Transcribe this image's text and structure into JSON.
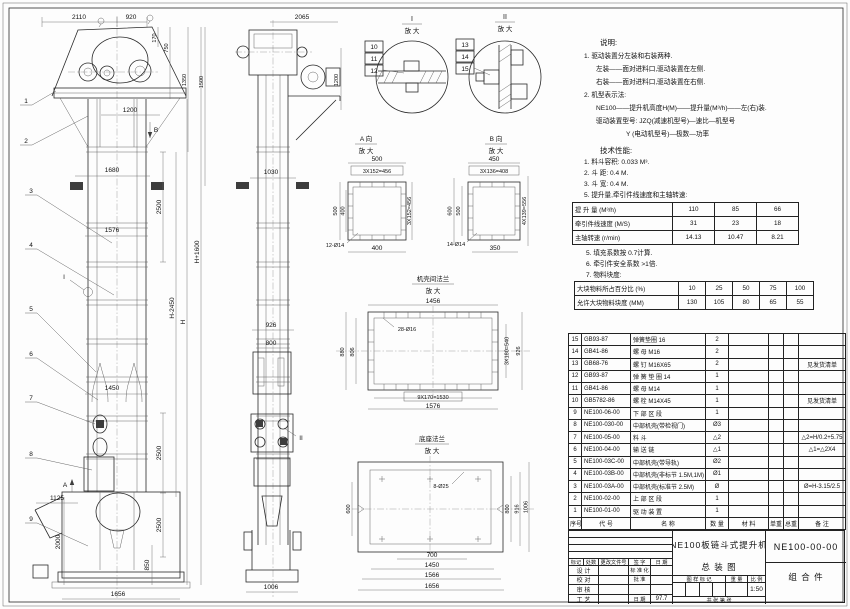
{
  "front_view": {
    "dims": {
      "a2110": "2110",
      "a920": "920",
      "a170": "170",
      "a750": "750",
      "a1350": "1350",
      "a1500": "1500",
      "a1200": "1200",
      "a1680": "1680",
      "a2500": "2500",
      "a1576": "1576",
      "aH1600": "H+1600",
      "aH2450": "H-2450",
      "aH": "H",
      "a1450": "1450",
      "a2500b": "2500",
      "a2500c": "2500",
      "a1125": "1125",
      "a2000": "2000",
      "a850": "850",
      "a1656": "1656"
    },
    "balloons": [
      "1",
      "2",
      "3",
      "4",
      "5",
      "6",
      "7",
      "8",
      "9"
    ],
    "labels": {
      "A": "A",
      "B": "B",
      "I": "I"
    }
  },
  "side_view": {
    "dims": {
      "a2065": "2065",
      "a1200": "1200",
      "a1030": "1030",
      "a926": "926",
      "a800": "800",
      "a1006": "1006"
    },
    "label_II": "II"
  },
  "detail_I": {
    "title": "I",
    "sub": "放 大",
    "balloons": [
      "10",
      "11",
      "12"
    ]
  },
  "detail_II": {
    "title": "II",
    "sub": "放 大",
    "balloons": [
      "13",
      "14",
      "15"
    ]
  },
  "view_A": {
    "title": "A 向",
    "sub": "放 大",
    "dims": {
      "top": "500",
      "top2": "3X152=456",
      "left": "500",
      "left2": "400",
      "right": "3X152=456",
      "bottom": "400",
      "holes": "12-Ø14"
    }
  },
  "view_B": {
    "title": "B 向",
    "sub": "放 大",
    "dims": {
      "top": "450",
      "top2": "3X136=408",
      "left": "600",
      "left2": "500",
      "right": "4X139=556",
      "bottom": "350",
      "holes": "14-Ø14"
    }
  },
  "flange_view": {
    "title": "机壳间法兰",
    "sub": "放 大",
    "dims": {
      "top": "1456",
      "holes": "28-Ø16",
      "left": "880",
      "left2": "806",
      "right": "3X180=540",
      "right2": "926",
      "bottom": "9X170=1530",
      "bottom2": "1576"
    }
  },
  "base_view": {
    "title": "底座法兰",
    "sub": "放 大",
    "dims": {
      "holes": "8-Ø25",
      "left": "600",
      "right": "800",
      "right2": "916",
      "right3": "1006",
      "bottom": "700",
      "bottom2": "1450",
      "bottom3": "1566",
      "bottom4": "1656"
    }
  },
  "notes": {
    "heading": "说明:",
    "lines": [
      "1. 驱动装置分左装和右装两种.",
      "左装——面对进料口,驱动装置在左侧.",
      "右装——面对进料口,驱动装置在右侧.",
      "2. 机型表示法:",
      "NE100——提升机高度H(M)——提升量(M³/h)——左(右)装.",
      "驱动装置型号: JZQ(减速机型号)—速比—机型号",
      "Y (电动机型号)—极数—功率"
    ],
    "tech_heading": "技术性能:",
    "tech_lines": [
      "1. 料斗容积: 0.033 M³.",
      "2. 斗  距: 0.4 M.",
      "3. 斗  宽: 0.4 M.",
      "5. 提升量,牵引件线速度和主轴转速:"
    ]
  },
  "capacity_table": {
    "rows": [
      [
        "提 升 量  (M³/h)",
        "110",
        "85",
        "66"
      ],
      [
        "牵引件线速度 (M/S)",
        "31",
        "23",
        "18"
      ],
      [
        "主轴转速 (r/min)",
        "14.13",
        "10.47",
        "8.21"
      ]
    ]
  },
  "notes2": [
    "5. 填充系数按 0.7计算.",
    "6. 牵引件安全系数 >1倍.",
    "7. 物料块度:"
  ],
  "lump_table": {
    "rows": [
      [
        "大块物料所占百分比 (%)",
        "10",
        "25",
        "50",
        "75",
        "100"
      ],
      [
        "允许大块物料块度 (MM)",
        "130",
        "105",
        "80",
        "65",
        "55"
      ]
    ]
  },
  "bom": {
    "headers": [
      "序号",
      "代  号",
      "名      称",
      "数 量",
      "材    料",
      "单重",
      "总重",
      "备  注"
    ],
    "rows": [
      [
        "15",
        "GB93-87",
        "弹簧垫圈  16",
        "2",
        "",
        "",
        "",
        ""
      ],
      [
        "14",
        "GB41-86",
        "螺 母  M16",
        "2",
        "",
        "",
        "",
        ""
      ],
      [
        "13",
        "GB68-76",
        "螺 钉  M16X65",
        "2",
        "",
        "",
        "",
        "见发货清单"
      ],
      [
        "12",
        "GB93-87",
        "弹 簧 垫 圈  14",
        "1",
        "",
        "",
        "",
        ""
      ],
      [
        "11",
        "GB41-86",
        "螺 母  M14",
        "1",
        "",
        "",
        "",
        ""
      ],
      [
        "10",
        "GB5782-86",
        "螺 栓  M14X45",
        "1",
        "",
        "",
        "",
        "见发货清单"
      ],
      [
        "9",
        "NE100-06-00",
        "下 部 区 段",
        "1",
        "",
        "",
        "",
        ""
      ],
      [
        "8",
        "NE100-030-00",
        "中部机壳(带检视门)",
        "Ø3",
        "",
        "",
        "",
        ""
      ],
      [
        "7",
        "NE100-05-00",
        "料  斗",
        "△2",
        "",
        "",
        "",
        "△2=H/0.2+5.75"
      ],
      [
        "6",
        "NE100-04-00",
        "输 送 链",
        "△1",
        "",
        "",
        "",
        "△1=△2X4"
      ],
      [
        "5",
        "NE100-03C-00",
        "中部机壳(带导轨)",
        "Ø2",
        "",
        "",
        "",
        ""
      ],
      [
        "4",
        "NE100-03B-00",
        "中部机壳(非标节 1.5M,1M)",
        "Ø1",
        "",
        "",
        "",
        ""
      ],
      [
        "3",
        "NE100-03A-00",
        "中部机壳(标准节 2.5M)",
        "Ø",
        "",
        "",
        "",
        "Ø=H-3.15/2.5"
      ],
      [
        "2",
        "NE100-02-00",
        "上 部 区 段",
        "1",
        "",
        "",
        "",
        ""
      ],
      [
        "1",
        "NE100-01-00",
        "驱 动 装 置",
        "1",
        "",
        "",
        "",
        ""
      ]
    ]
  },
  "title_block": {
    "product": "NE100板链斗式提升机",
    "sheet_name": "总  装  图",
    "drawing_no": "NE100-00-00",
    "part_class": "组 合 件",
    "rev_header": [
      "标记",
      "处数",
      "更改文件号",
      "签 字",
      "日 期"
    ],
    "sig_rows": [
      [
        "设 计",
        "标 准 化"
      ],
      [
        "校 对",
        "批 准"
      ],
      [
        "审 核",
        ""
      ],
      [
        "工 艺",
        "日 期"
      ]
    ],
    "date_value": "97.7",
    "stamp_header": [
      "图 样 标 记",
      "重 量",
      "比 例"
    ],
    "scale_value": "1:50",
    "sheet_count": "共   张  第   张"
  }
}
